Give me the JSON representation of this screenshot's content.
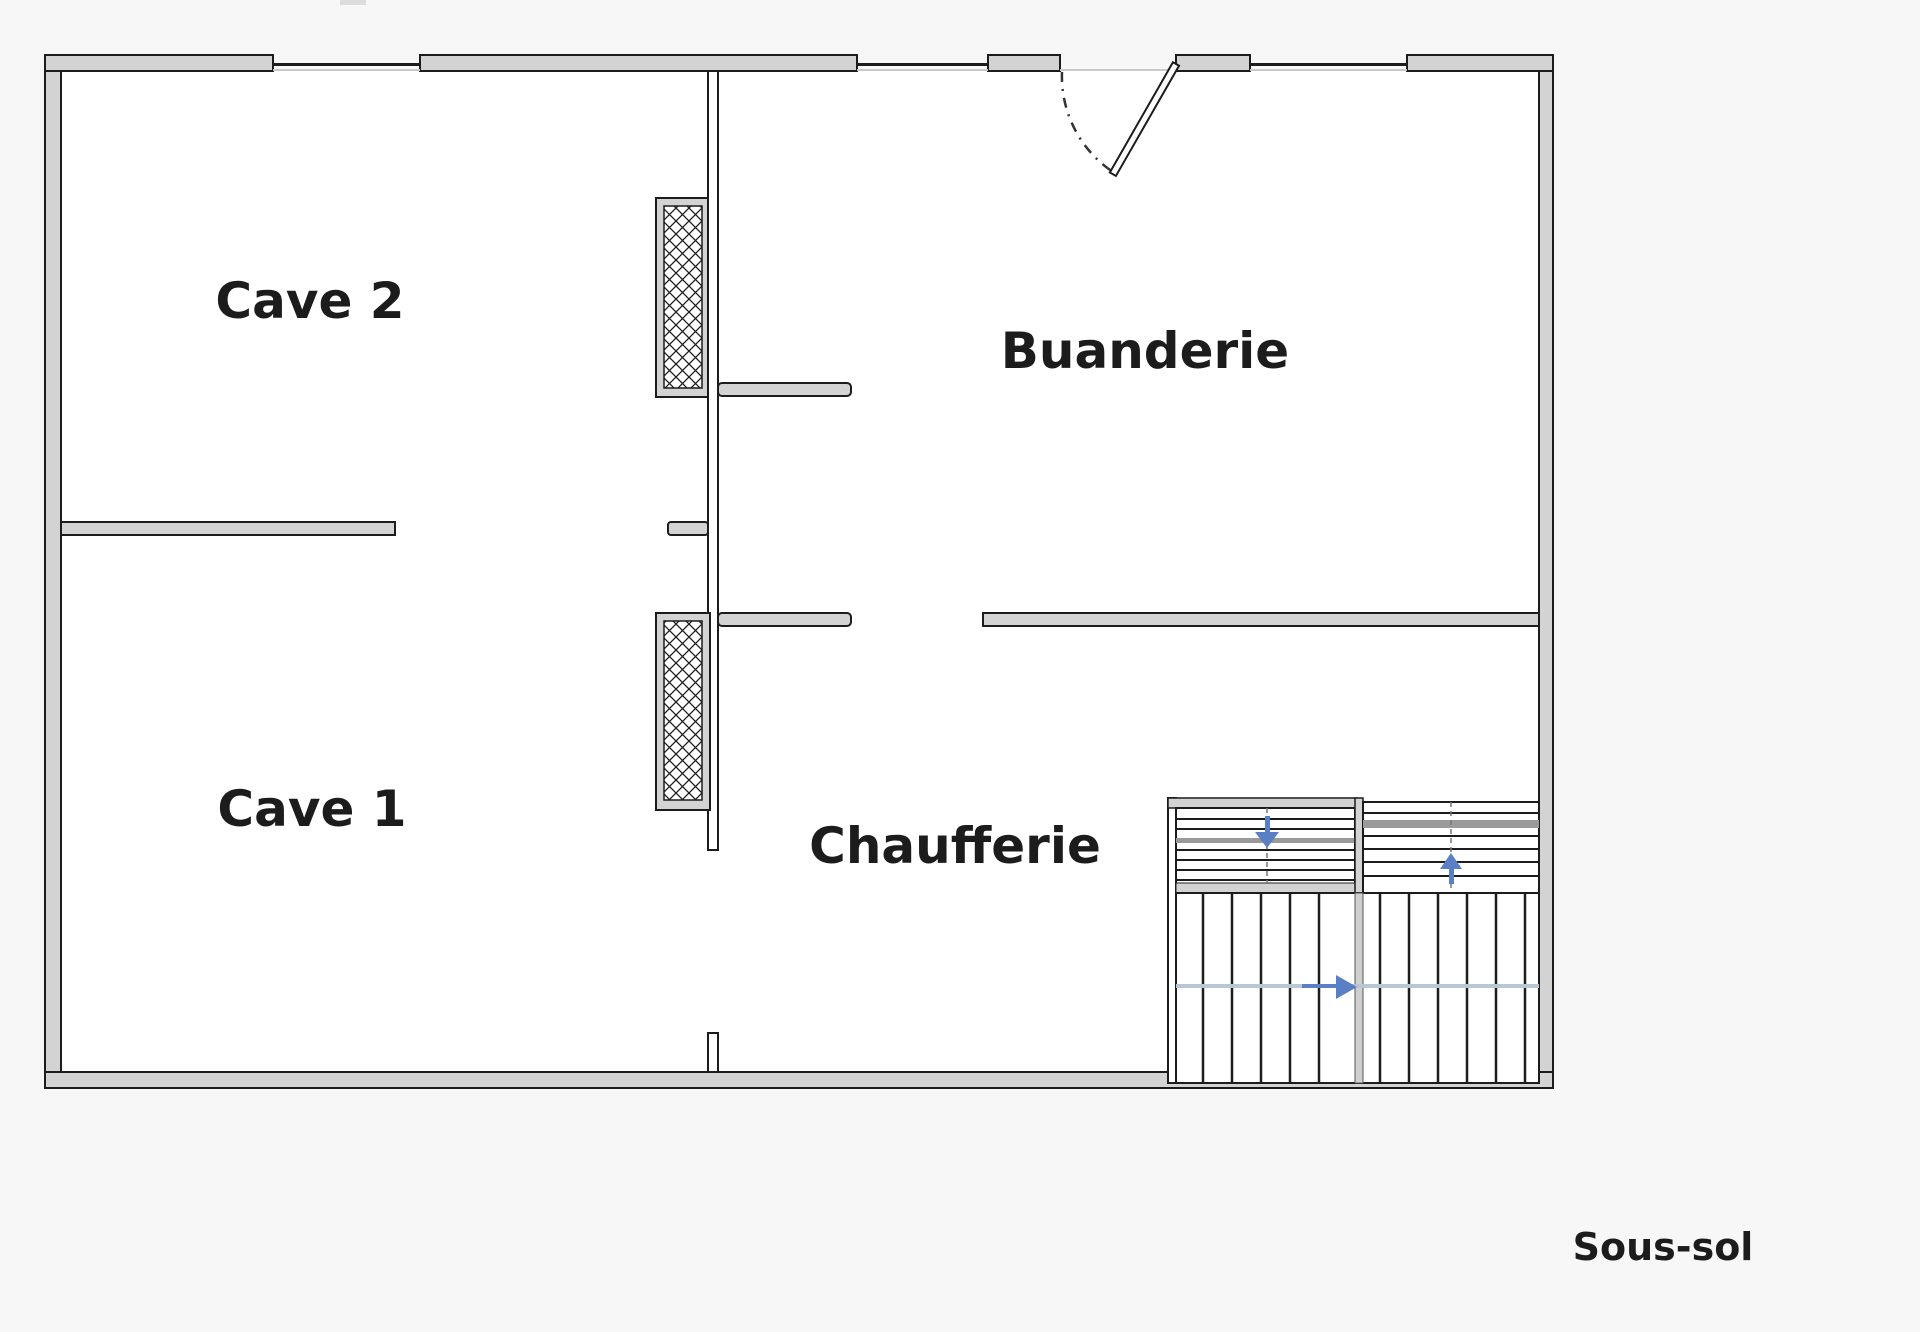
{
  "plan": {
    "floor_label": "Sous-sol",
    "rooms": [
      {
        "name": "cave-2",
        "label": "Cave 2"
      },
      {
        "name": "cave-1",
        "label": "Cave 1"
      },
      {
        "name": "buanderie",
        "label": "Buanderie"
      },
      {
        "name": "chaufferie",
        "label": "Chaufferie"
      }
    ],
    "stairs": {
      "flights": [
        {
          "name": "upper-left-flight",
          "direction": "down",
          "steps": 8
        },
        {
          "name": "upper-right-flight",
          "direction": "up",
          "steps": 8
        },
        {
          "name": "lower-flight",
          "direction": "right",
          "steps": 13
        }
      ]
    },
    "features": {
      "entry_door": "swing-door-top-right",
      "shafts": [
        "hatched-shaft-upper",
        "hatched-shaft-lower"
      ],
      "windows_top_wall": 3
    },
    "colors": {
      "wall_fill": "#d3d3d3",
      "line": "#1c1c1c",
      "arrow": "#5b7fc4",
      "walking_line": "#b9c6d6",
      "floor": "#ffffff"
    }
  }
}
